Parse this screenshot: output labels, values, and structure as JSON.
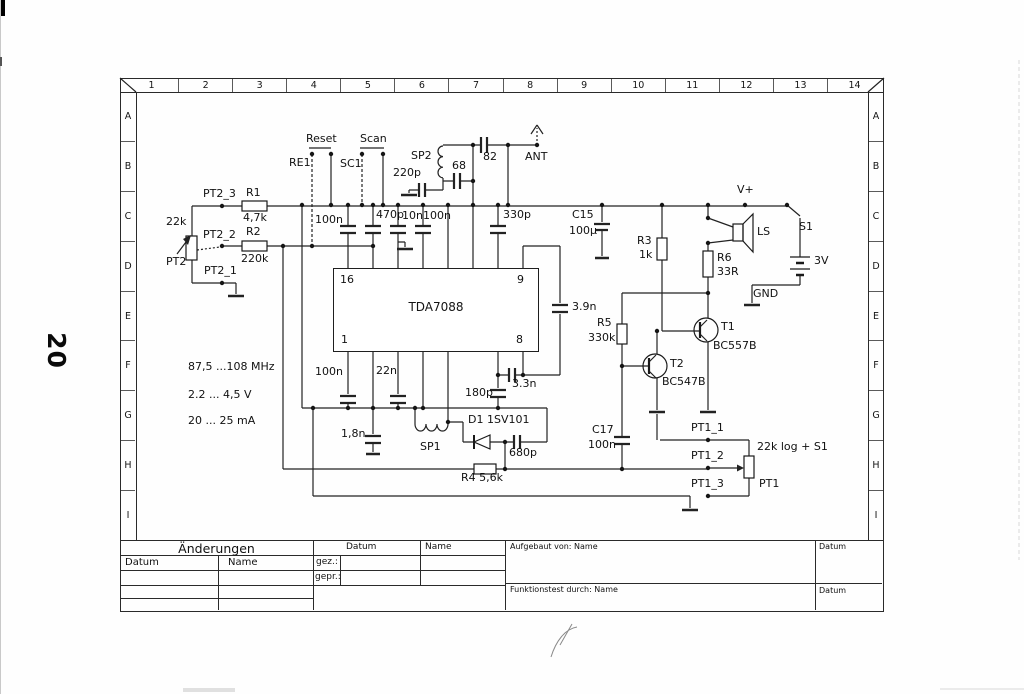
{
  "page": {
    "number": "20"
  },
  "frame": {
    "columns": [
      "1",
      "2",
      "3",
      "4",
      "5",
      "6",
      "7",
      "8",
      "9",
      "10",
      "11",
      "12",
      "13",
      "14"
    ],
    "rows": [
      "A",
      "B",
      "C",
      "D",
      "E",
      "F",
      "G",
      "H",
      "I"
    ]
  },
  "ic": {
    "name": "TDA7088",
    "pin_top_left": "16",
    "pin_top_right": "9",
    "pin_bottom_left": "1",
    "pin_bottom_right": "8"
  },
  "specs": {
    "frequency": "87,5 ...108 MHz",
    "voltage": "2.2 ... 4,5 V",
    "current": "20 ... 25 mA"
  },
  "labels": [
    {
      "id": "reset",
      "text": "Reset",
      "x": 306,
      "y": 133
    },
    {
      "id": "scan",
      "text": "Scan",
      "x": 360,
      "y": 133
    },
    {
      "id": "re1",
      "text": "RE1",
      "x": 289,
      "y": 157
    },
    {
      "id": "sc1",
      "text": "SC1",
      "x": 340,
      "y": 158
    },
    {
      "id": "sp2",
      "text": "SP2",
      "x": 411,
      "y": 150
    },
    {
      "id": "cap-220p",
      "text": "220p",
      "x": 393,
      "y": 167
    },
    {
      "id": "cap-68",
      "text": "68",
      "x": 452,
      "y": 160
    },
    {
      "id": "cap-82",
      "text": "82",
      "x": 483,
      "y": 151
    },
    {
      "id": "ant",
      "text": "ANT",
      "x": 525,
      "y": 151
    },
    {
      "id": "pt2-3",
      "text": "PT2_3",
      "x": 203,
      "y": 188
    },
    {
      "id": "r1",
      "text": "R1",
      "x": 246,
      "y": 187
    },
    {
      "id": "r1-value",
      "text": "4,7k",
      "x": 243,
      "y": 212
    },
    {
      "id": "pt2-22k",
      "text": "22k",
      "x": 166,
      "y": 216
    },
    {
      "id": "pt2-2",
      "text": "PT2_2",
      "x": 203,
      "y": 229
    },
    {
      "id": "r2",
      "text": "R2",
      "x": 246,
      "y": 226
    },
    {
      "id": "r2-value",
      "text": "220k",
      "x": 241,
      "y": 253
    },
    {
      "id": "pt2",
      "text": "PT2",
      "x": 166,
      "y": 256
    },
    {
      "id": "pt2-1",
      "text": "PT2_1",
      "x": 204,
      "y": 265
    },
    {
      "id": "cap-100n-1",
      "text": "100n",
      "x": 315,
      "y": 214
    },
    {
      "id": "cap-470p",
      "text": "470p",
      "x": 376,
      "y": 209
    },
    {
      "id": "cap-10n",
      "text": "10n",
      "x": 402,
      "y": 210
    },
    {
      "id": "cap-100n-2",
      "text": "100n",
      "x": 423,
      "y": 210
    },
    {
      "id": "cap-330p",
      "text": "330p",
      "x": 503,
      "y": 209
    },
    {
      "id": "c15",
      "text": "C15",
      "x": 572,
      "y": 209
    },
    {
      "id": "c15-value",
      "text": "100µ",
      "x": 569,
      "y": 225
    },
    {
      "id": "r3",
      "text": "R3",
      "x": 637,
      "y": 235
    },
    {
      "id": "r3-value",
      "text": "1k",
      "x": 639,
      "y": 249
    },
    {
      "id": "vplus",
      "text": "V+",
      "x": 737,
      "y": 184
    },
    {
      "id": "ls",
      "text": "LS",
      "x": 757,
      "y": 226
    },
    {
      "id": "s1",
      "text": "S1",
      "x": 799,
      "y": 221
    },
    {
      "id": "r6",
      "text": "R6",
      "x": 717,
      "y": 252
    },
    {
      "id": "r6-value",
      "text": "33R",
      "x": 717,
      "y": 266
    },
    {
      "id": "battery-3v",
      "text": "3V",
      "x": 814,
      "y": 255
    },
    {
      "id": "gnd",
      "text": "GND",
      "x": 753,
      "y": 288
    },
    {
      "id": "cap-3p9n",
      "text": "3.9n",
      "x": 572,
      "y": 301
    },
    {
      "id": "r5",
      "text": "R5",
      "x": 597,
      "y": 317
    },
    {
      "id": "r5-value",
      "text": "330k",
      "x": 588,
      "y": 332
    },
    {
      "id": "t1",
      "text": "T1",
      "x": 721,
      "y": 321
    },
    {
      "id": "t1-type",
      "text": "BC557B",
      "x": 713,
      "y": 340
    },
    {
      "id": "t2",
      "text": "T2",
      "x": 670,
      "y": 358
    },
    {
      "id": "t2-type",
      "text": "BC547B",
      "x": 662,
      "y": 376
    },
    {
      "id": "cap-100n-3",
      "text": "100n",
      "x": 315,
      "y": 366
    },
    {
      "id": "cap-22n",
      "text": "22n",
      "x": 376,
      "y": 365
    },
    {
      "id": "cap-180p",
      "text": "180p",
      "x": 465,
      "y": 387
    },
    {
      "id": "cap-3p3n",
      "text": "3.3n",
      "x": 512,
      "y": 378
    },
    {
      "id": "cap-1p8n",
      "text": "1,8n",
      "x": 341,
      "y": 428
    },
    {
      "id": "sp1",
      "text": "SP1",
      "x": 420,
      "y": 441
    },
    {
      "id": "d1",
      "text": "D1 1SV101",
      "x": 468,
      "y": 414
    },
    {
      "id": "cap-680p",
      "text": "680p",
      "x": 509,
      "y": 447
    },
    {
      "id": "r4",
      "text": "R4  5,6k",
      "x": 461,
      "y": 472
    },
    {
      "id": "c17",
      "text": "C17",
      "x": 592,
      "y": 424
    },
    {
      "id": "c17-value",
      "text": "100n",
      "x": 588,
      "y": 439
    },
    {
      "id": "pt1-1",
      "text": "PT1_1",
      "x": 691,
      "y": 422
    },
    {
      "id": "pt1-2",
      "text": "PT1_2",
      "x": 691,
      "y": 450
    },
    {
      "id": "pt1-3",
      "text": "PT1_3",
      "x": 691,
      "y": 478
    },
    {
      "id": "pt1-value",
      "text": "22k log + S1",
      "x": 757,
      "y": 441
    },
    {
      "id": "pt1",
      "text": "PT1",
      "x": 759,
      "y": 478
    }
  ],
  "title_block": {
    "aenderungen": "Änderungen",
    "datum": "Datum",
    "name": "Name",
    "gez": "gez.:",
    "gepr": "gepr.:",
    "datum2": "Datum",
    "name2": "Name",
    "aufgebaut": "Aufgebaut von: Name",
    "aufgebaut_datum": "Datum",
    "funktionstest": "Funktionstest durch: Name",
    "funktionstest_datum": "Datum"
  }
}
